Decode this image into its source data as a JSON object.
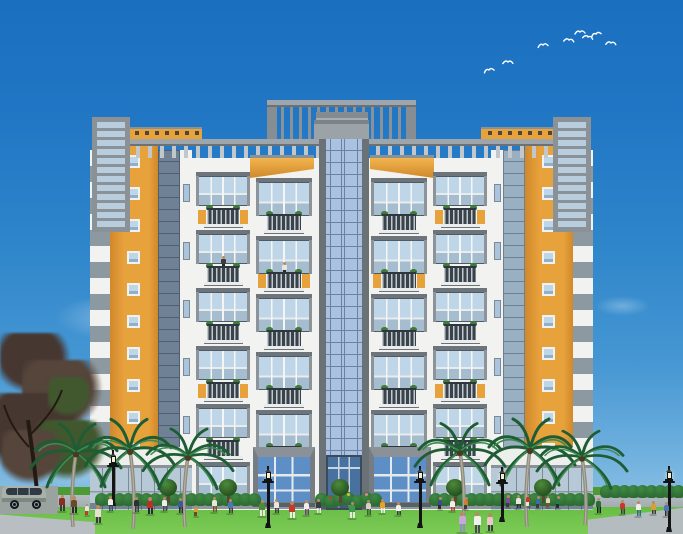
{
  "meta": {
    "title": "apartment-complex-elevation-rendering",
    "description": "Architectural elevation rendering of a symmetric multi-storey apartment building with a central glass tower, balcony wings, orange accent towers, palm trees, street lamps and pedestrians on a lawn under a blue sky with birds"
  },
  "palette": {
    "sky_top": "#1a6fbf",
    "sky_mid": "#2e85ca",
    "sky_low": "#6fb0de",
    "orange": "#e8a23c",
    "orange_deep": "#d0882a",
    "orange_light": "#f2b44e",
    "white_wall": "#f2f3f0",
    "white_dim": "#e7e9e8",
    "gray_frame": "#8a9297",
    "gray_mid": "#9fa6ab",
    "gray_dark": "#5f6870",
    "gray_darker": "#3e464e",
    "gray_light": "#c2c7cb",
    "stripe_gray": "#8d99a1",
    "glass_pale": "#bfd6e9",
    "glass_tower": "#a9c2e1",
    "glass_line": "#7081a0",
    "glass_store": "#b7c9d7",
    "glass_entry": "#5d8ec6",
    "glass_entry_dark": "#49719f",
    "plant": "#3f7a38",
    "hedge_dark": "#2e6b35",
    "hedge_light": "#3e8a42",
    "grass_dark": "#4e9a34",
    "grass_light": "#7ccb56",
    "walkway": "#a3adb1",
    "pavement": "#b9bec2",
    "palm_dark": "#1e5c34",
    "palm_light": "#3e8a50",
    "palm_trunk": "#8e8a7c",
    "lamp_black": "#141414",
    "bird_white": "#ffffff",
    "tree_dark": "#473731",
    "tree_mid": "#55453a",
    "tree_green": "#41582f",
    "skin": "#b98a62",
    "van_body": "#a8b2a8",
    "van_window": "#2f3a44",
    "flower_colors": [
      "#c23a2e",
      "#d8c037",
      "#e87aa0"
    ]
  },
  "building": {
    "balcony_units_per_column": 6,
    "orange_tower_window_count": 10,
    "parapet_dot_count": 9,
    "orange_flank_units_outer": [
      0,
      3
    ],
    "orange_flank_units_inner": [
      1,
      4
    ],
    "balcony_people": [
      {
        "col": 0,
        "unit": 1,
        "shirt": "#3a3a40"
      },
      {
        "col": 1,
        "unit": 1,
        "shirt": "#e8e8e0"
      }
    ]
  },
  "scene": {
    "birds": [
      [
        483,
        66,
        -10
      ],
      [
        502,
        58,
        5
      ],
      [
        537,
        41,
        -5
      ],
      [
        563,
        36,
        10
      ],
      [
        574,
        28,
        0
      ],
      [
        582,
        33,
        15
      ],
      [
        590,
        30,
        -15
      ],
      [
        605,
        39,
        8
      ]
    ],
    "clouds": [
      [
        55,
        295,
        110,
        45,
        0.3
      ],
      [
        25,
        370,
        150,
        70,
        0.45
      ],
      [
        0,
        418,
        160,
        70,
        0.55
      ],
      [
        115,
        245,
        80,
        30,
        0.22
      ],
      [
        595,
        296,
        55,
        20,
        0.28
      ],
      [
        320,
        212,
        60,
        20,
        0.12
      ]
    ],
    "palms": [
      {
        "x": 73,
        "base": 527,
        "h": 105,
        "flip": false
      },
      {
        "x": 133,
        "base": 529,
        "h": 112,
        "flip": true
      },
      {
        "x": 185,
        "base": 527,
        "h": 100,
        "flip": false
      },
      {
        "x": 463,
        "base": 524,
        "h": 102,
        "flip": true
      },
      {
        "x": 527,
        "base": 527,
        "h": 110,
        "flip": false
      },
      {
        "x": 585,
        "base": 525,
        "h": 96,
        "flip": true
      }
    ],
    "lamps": [
      {
        "x": 113,
        "base": 506,
        "h": 56
      },
      {
        "x": 268,
        "base": 528,
        "h": 62
      },
      {
        "x": 420,
        "base": 528,
        "h": 62
      },
      {
        "x": 502,
        "base": 522,
        "h": 55
      },
      {
        "x": 669,
        "base": 532,
        "h": 66
      }
    ],
    "topiary": [
      168,
      228,
      340,
      455,
      543
    ],
    "hedges": [
      [
        95,
        250,
        506
      ],
      [
        315,
        371,
        506
      ],
      [
        429,
        585,
        506
      ],
      [
        600,
        681,
        498
      ]
    ],
    "van": {
      "x": 2,
      "y": 481
    },
    "people": [
      [
        62,
        512,
        17,
        "#8a2e24",
        "#3a3a40"
      ],
      [
        74,
        514,
        18,
        "#6b4a2a",
        "#2a2a30"
      ],
      [
        87,
        516,
        12,
        "#e8e4d8",
        "#c03a2e"
      ],
      [
        98,
        524,
        19,
        "#e8e0d0",
        "#3a3a40"
      ],
      [
        110,
        512,
        16,
        "#f0eee6",
        "#3a4a6a"
      ],
      [
        136,
        513,
        16,
        "#2a3038",
        "#3a3a40"
      ],
      [
        150,
        515,
        18,
        "#b83228",
        "#2a2a30"
      ],
      [
        164,
        512,
        15,
        "#efefe8",
        "#4a4a50"
      ],
      [
        180,
        514,
        16,
        "#3a5a9a",
        "#2a2a30"
      ],
      [
        196,
        517,
        11,
        "#d8a030",
        "#6b4a2a"
      ],
      [
        214,
        513,
        16,
        "#e8e8e0",
        "#7a5230"
      ],
      [
        230,
        514,
        15,
        "#4a78b8",
        "#3a3a40"
      ],
      [
        262,
        517,
        17,
        "#4a8a3a",
        "#e8e8e0"
      ],
      [
        276,
        514,
        15,
        "#e8e8e0",
        "#3a3a40"
      ],
      [
        292,
        519,
        18,
        "#c03a2e",
        "#f0f0ec"
      ],
      [
        306,
        516,
        16,
        "#f0eee8",
        "#7a3a8a"
      ],
      [
        318,
        514,
        15,
        "#3a3a40",
        "#e8e8e0"
      ],
      [
        352,
        519,
        17,
        "#3e9a4a",
        "#e8e8e0"
      ],
      [
        368,
        516,
        16,
        "#d8d0c0",
        "#3a5a3a"
      ],
      [
        382,
        514,
        15,
        "#e8a028",
        "#f0f0ec"
      ],
      [
        398,
        516,
        14,
        "#f0f0ec",
        "#3a3a40"
      ],
      [
        440,
        510,
        13,
        "#3a4a9a",
        "#2a2a30"
      ],
      [
        452,
        512,
        14,
        "#f0eee6",
        "#c03a2e"
      ],
      [
        466,
        510,
        13,
        "#d87a28",
        "#3a3a40"
      ],
      [
        462,
        533,
        21,
        "#c8a8d8",
        "#9090c0"
      ],
      [
        477,
        534,
        22,
        "#f0f0ec",
        "#4a4a50"
      ],
      [
        490,
        532,
        19,
        "#e8c8c8",
        "#3a3a40"
      ],
      [
        508,
        508,
        13,
        "#8a4a9a",
        "#3a3a40"
      ],
      [
        518,
        509,
        14,
        "#e8e8e0",
        "#2a2a30"
      ],
      [
        528,
        507,
        12,
        "#c03a2e",
        "#e8e8e0"
      ],
      [
        538,
        509,
        13,
        "#3a6ab0",
        "#3a3a40"
      ],
      [
        548,
        508,
        12,
        "#e8d8c0",
        "#7a5230"
      ],
      [
        558,
        509,
        13,
        "#2a7a4a",
        "#2a2a30"
      ],
      [
        598,
        514,
        16,
        "#2a6a3a",
        "#1a1a20"
      ],
      [
        622,
        515,
        15,
        "#c03a2e",
        "#3a3a40"
      ],
      [
        638,
        517,
        16,
        "#f0eee6",
        "#2a6a8a"
      ],
      [
        653,
        515,
        14,
        "#d8a030",
        "#3a3a40"
      ],
      [
        666,
        517,
        15,
        "#4a78b8",
        "#2a2a30"
      ]
    ]
  }
}
